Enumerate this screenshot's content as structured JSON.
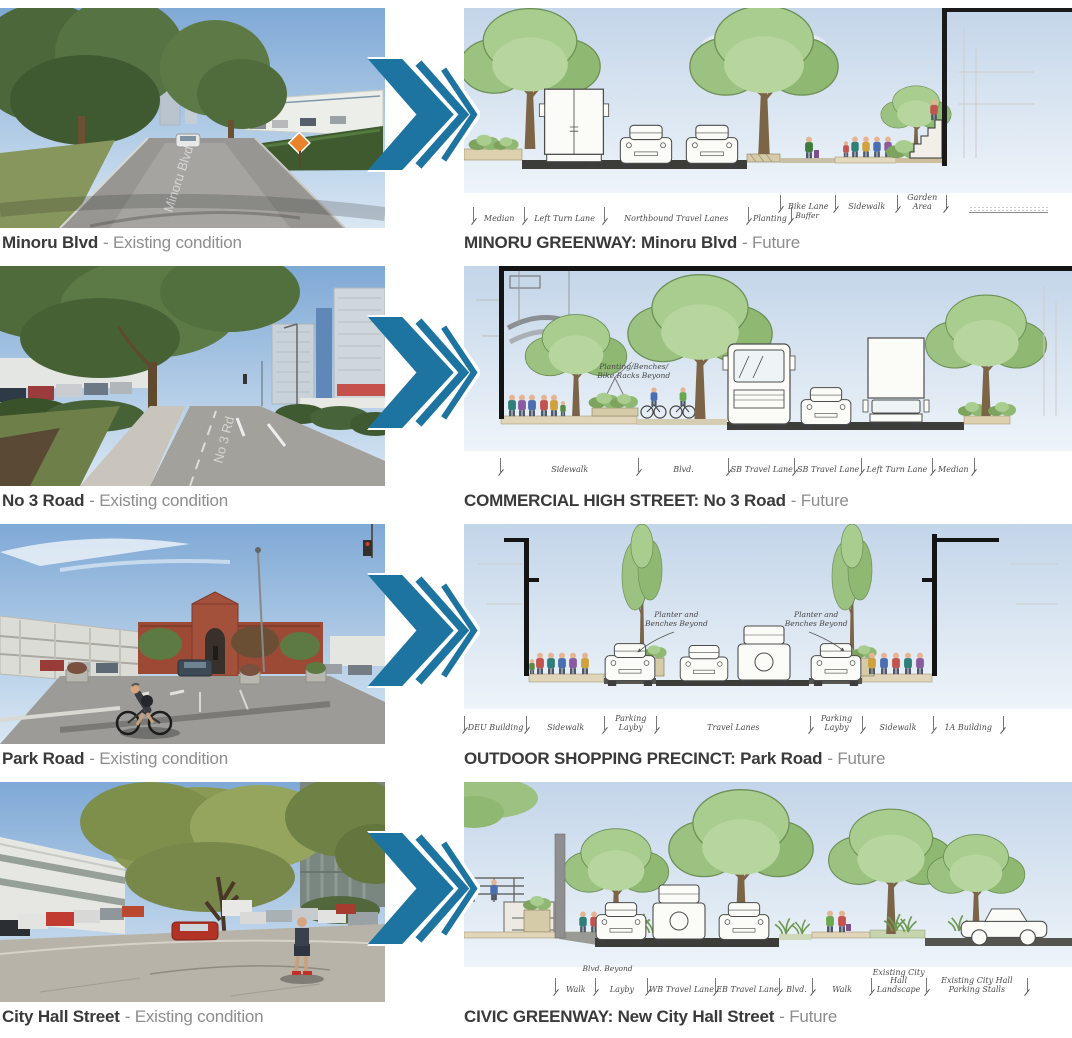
{
  "colors": {
    "arrow_accent": "#1e74a0",
    "caption_dark": "#3a3a3a",
    "caption_gray": "#8d8d8d"
  },
  "arrow": {
    "meaning": "transforms-into",
    "direction": "right"
  },
  "rows": [
    {
      "photo": {
        "caption_name": "Minoru Blvd",
        "caption_status": "- Existing condition",
        "watermark": "Minoru Blvd"
      },
      "future": {
        "caption_title": "MINORU GREENWAY: Minoru Blvd",
        "caption_status": "- Future",
        "buffer_label": "Buffer",
        "dims_road": [
          "Median",
          "Left Turn Lane",
          "Northbound Travel Lanes",
          "Planting"
        ],
        "dims_walk": [
          "Bike Lane",
          "Sidewalk",
          "Garden Area"
        ]
      }
    },
    {
      "photo": {
        "caption_name": "No 3 Road",
        "caption_status": "- Existing condition",
        "watermark": "No 3 Rd"
      },
      "future": {
        "caption_title": "COMMERCIAL HIGH STREET: No 3 Road",
        "caption_status": "- Future",
        "annotation": "Planting/Benches/\nBike Racks Beyond",
        "dims": [
          "Sidewalk",
          "Blvd.",
          "SB Travel Lane",
          "SB Travel Lane",
          "Left Turn Lane",
          "Median"
        ]
      }
    },
    {
      "photo": {
        "caption_name": "Park Road",
        "caption_status": "- Existing condition"
      },
      "future": {
        "caption_title": "OUTDOOR SHOPPING PRECINCT: Park Road",
        "caption_status": "- Future",
        "annotation_left": "Planter and\nBenches Beyond",
        "annotation_right": "Planter and\nBenches Beyond",
        "dims": [
          "DEU Building",
          "Sidewalk",
          "Parking Layby",
          "Travel Lanes",
          "Parking Layby",
          "Sidewalk",
          "1A Building"
        ]
      }
    },
    {
      "photo": {
        "caption_name": "City Hall Street",
        "caption_status": "- Existing condition"
      },
      "future": {
        "caption_title": "CIVIC GREENWAY: New City Hall Street",
        "caption_status": "- Future",
        "annotation": "Blvd. Beyond",
        "dims": [
          "Walk",
          "Layby",
          "WB Travel Lane",
          "EB Travel Lane",
          "Blvd.",
          "Walk",
          "Existing City Hall\nLandscape",
          "Existing City Hall\nParking Stalls"
        ]
      }
    }
  ]
}
